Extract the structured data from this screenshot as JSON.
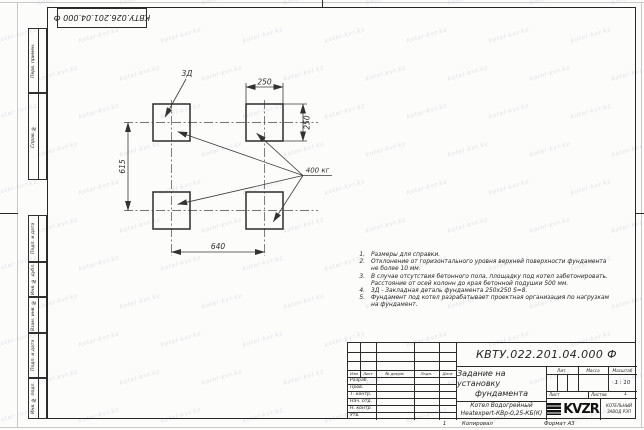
{
  "sheet": {
    "top_stamp": "КВТУ.026.201.04.000 Ф",
    "watermark_text": "kotel-kvr.kz",
    "zone_number": "1",
    "copied_label": "Копировал",
    "format_label": "Формат А3"
  },
  "side_column": {
    "items": [
      {
        "label": "Перв. примен."
      },
      {
        "label": "Справ. №"
      },
      {
        "label": "Подп. и дата"
      },
      {
        "label": "Инв. № дубл."
      },
      {
        "label": "Взам. инв. №"
      },
      {
        "label": "Подп. и дата"
      },
      {
        "label": "Инв. № подл."
      }
    ]
  },
  "drawing": {
    "embed_label": "3Д",
    "load_label": "400 кг",
    "dim_width_top": "250",
    "dim_height_right": "250",
    "dim_vertical_left": "615",
    "dim_horizontal_bottom": "640"
  },
  "notes": {
    "items": [
      {
        "num": "1.",
        "text": "Размеры для справки."
      },
      {
        "num": "2.",
        "text": "Отклонение от горизонтального уровня верхней поверхности фундамента не более 10 мм."
      },
      {
        "num": "3.",
        "text": "В случае отсутствия бетонного пола, площадку под котел забетонировать. Расстояние от осей колонн до края бетонной подушки 500 мм."
      },
      {
        "num": "4.",
        "text": "3Д - Закладная деталь фундамента 250х250 S=8."
      },
      {
        "num": "5.",
        "text": "Фундамент под котел разрабатывает проектная организация по нагрузкам на фундамент."
      }
    ]
  },
  "title_block": {
    "doc_number": "КВТУ.022.201.04.000 Ф",
    "title_line1": "Задание на установку",
    "title_line2": "фундамента",
    "product_line1": "Котел Водогрейный",
    "product_line2": "Heatexpert-КВр-0,25-КБ(К)",
    "rev_header": {
      "izm": "Изм",
      "list": "Лист",
      "docnum": "№ докум.",
      "podp": "Подп.",
      "data": "Дата"
    },
    "roles": [
      "Разраб.",
      "Пров.",
      "Т. контр.",
      "Нач. отд.",
      "Н. контр.",
      "Утв."
    ],
    "lit_label": "Лит.",
    "mass_label": "Масса",
    "scale_label": "Масштаб",
    "scale_value": "1 : 10",
    "sheet_label": "Лист",
    "sheets_label": "Листов",
    "sheets_value": "1",
    "logo_text": "KVZR",
    "logo_caption_line1": "КОТЕЛЬНЫЙ",
    "logo_caption_line2": "ЗАВОД РЭП"
  }
}
